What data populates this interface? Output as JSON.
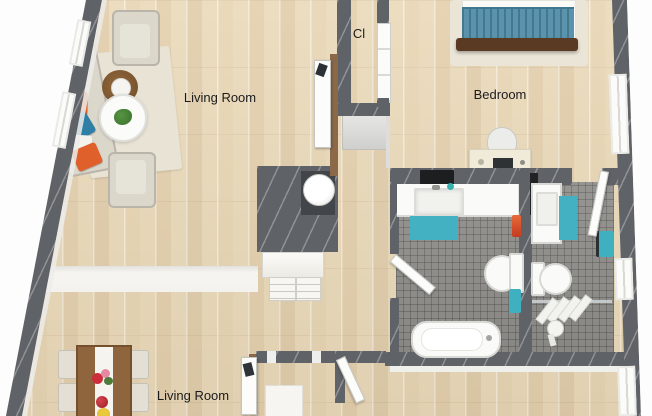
{
  "floor_plan": {
    "rooms": [
      {
        "id": "living-room-top",
        "label": "Living Room"
      },
      {
        "id": "closet",
        "label": "Cl"
      },
      {
        "id": "bedroom",
        "label": "Bedroom"
      },
      {
        "id": "living-room-bottom",
        "label": "Living Room"
      }
    ],
    "fixtures": [
      "sofa",
      "armchairs",
      "coffee-table",
      "side-table",
      "bed",
      "desk",
      "desk-chair",
      "dining-table",
      "dining-chairs",
      "water-heater",
      "kitchen-counter",
      "bathtub",
      "toilets",
      "sink-vanities",
      "shower",
      "bath-mats",
      "towels",
      "doors",
      "windows"
    ],
    "palette": {
      "wood_floor": "#ead9b9",
      "wall": "#5f6266",
      "tile_floor": "#908f8b",
      "accent_teal": "#41b2c2",
      "accent_orange": "#e0602c",
      "accent_blue": "#2e7ea6",
      "accent_dark_teal": "#14506b",
      "rug": "#e8e3d4",
      "furniture_wood": "#8e653c",
      "outside": "#fdfdfd"
    }
  }
}
